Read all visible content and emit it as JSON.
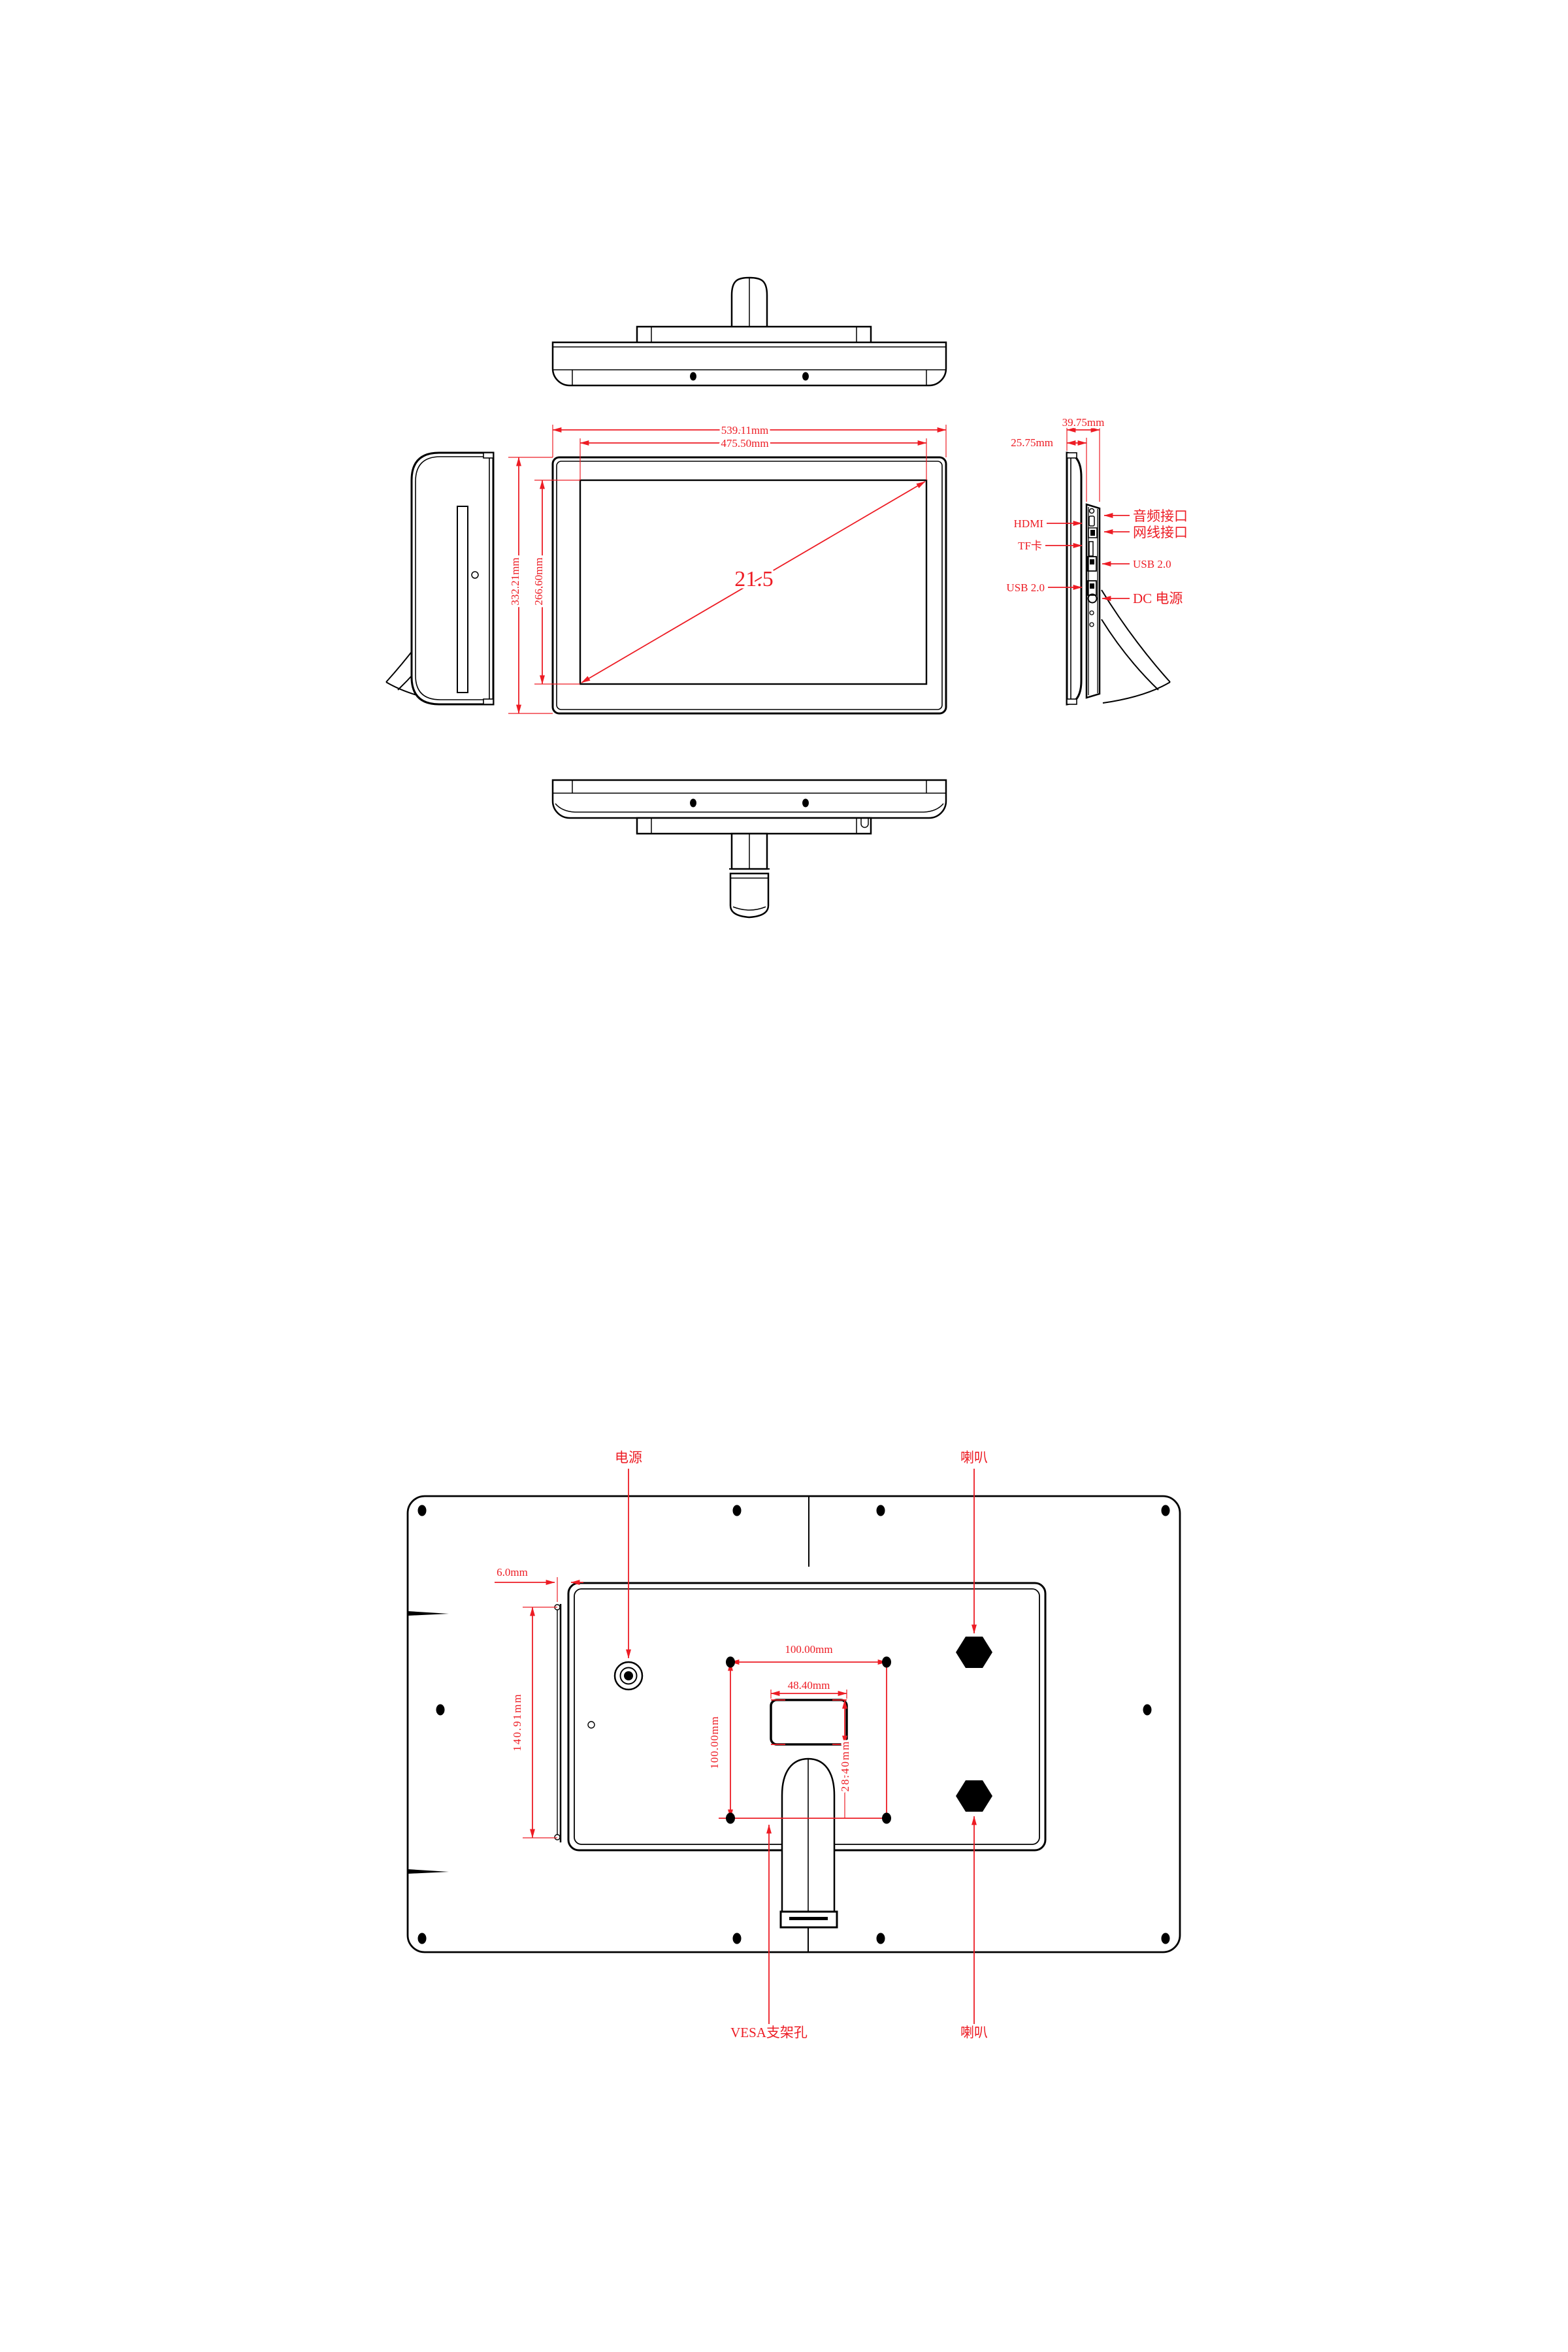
{
  "accent_color": "#ED1C24",
  "front_view": {
    "outer_width": "539.11mm",
    "screen_width": "475.50mm",
    "outer_height": "332.21mm",
    "screen_height": "266.60mm",
    "diagonal_inches": "21.5"
  },
  "side_view": {
    "depth_total": "39.75mm",
    "depth_body": "25.75mm",
    "port_hdmi": "HDMI",
    "port_tf": "TF卡",
    "port_usb_left": "USB 2.0",
    "port_audio": "音频接口",
    "port_lan": "网线接口",
    "port_usb_right": "USB 2.0",
    "port_dc": "DC 电源"
  },
  "rear_view": {
    "label_power": "电源",
    "label_speaker_top": "喇叭",
    "label_speaker_bottom": "喇叭",
    "label_vesa": "VESA支架孔",
    "dim_hinge_offset": "6.0mm",
    "dim_bracket_height": "140.91mm",
    "dim_vesa_width": "100.00mm",
    "dim_vesa_height": "100.00mm",
    "dim_stand_slot_width": "48.40mm",
    "dim_stand_slot_height": "28.40mm"
  }
}
